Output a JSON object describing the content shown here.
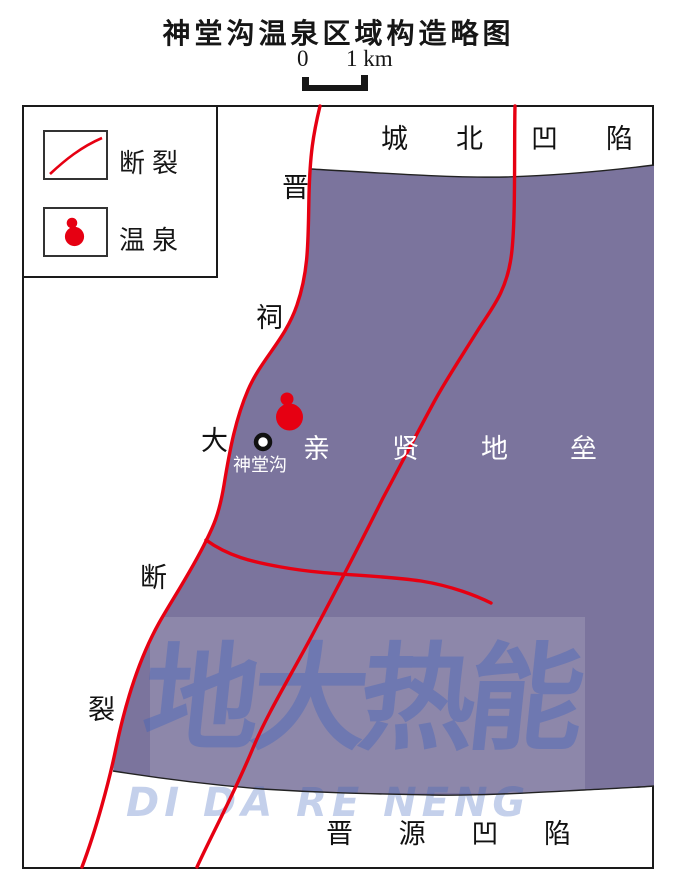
{
  "page": {
    "title": "神堂沟温泉区域构造略图"
  },
  "scale_bar": {
    "zero_label": "0",
    "unit_label": "1 km"
  },
  "legend": {
    "fault_label": "断裂",
    "spring_label": "温泉"
  },
  "map": {
    "chengbei_depression": [
      "城",
      "北",
      "凹",
      "陷"
    ],
    "qinxian_horst": [
      "亲",
      "贤",
      "地",
      "垒"
    ],
    "jinyuan_depression": [
      "晋",
      "源",
      "凹",
      "陷"
    ],
    "jinci_fault": [
      "晋",
      "祠",
      "大",
      "断",
      "裂"
    ],
    "spring_site": "神堂沟"
  },
  "watermark": {
    "cn": "地大热能",
    "en": "DI DA RE NENG"
  },
  "colors": {
    "fault_red": "#e60012",
    "horst_fill": "#7b749d",
    "watermark_blue": "#3c62bc",
    "line_black": "#1a1a1a"
  }
}
